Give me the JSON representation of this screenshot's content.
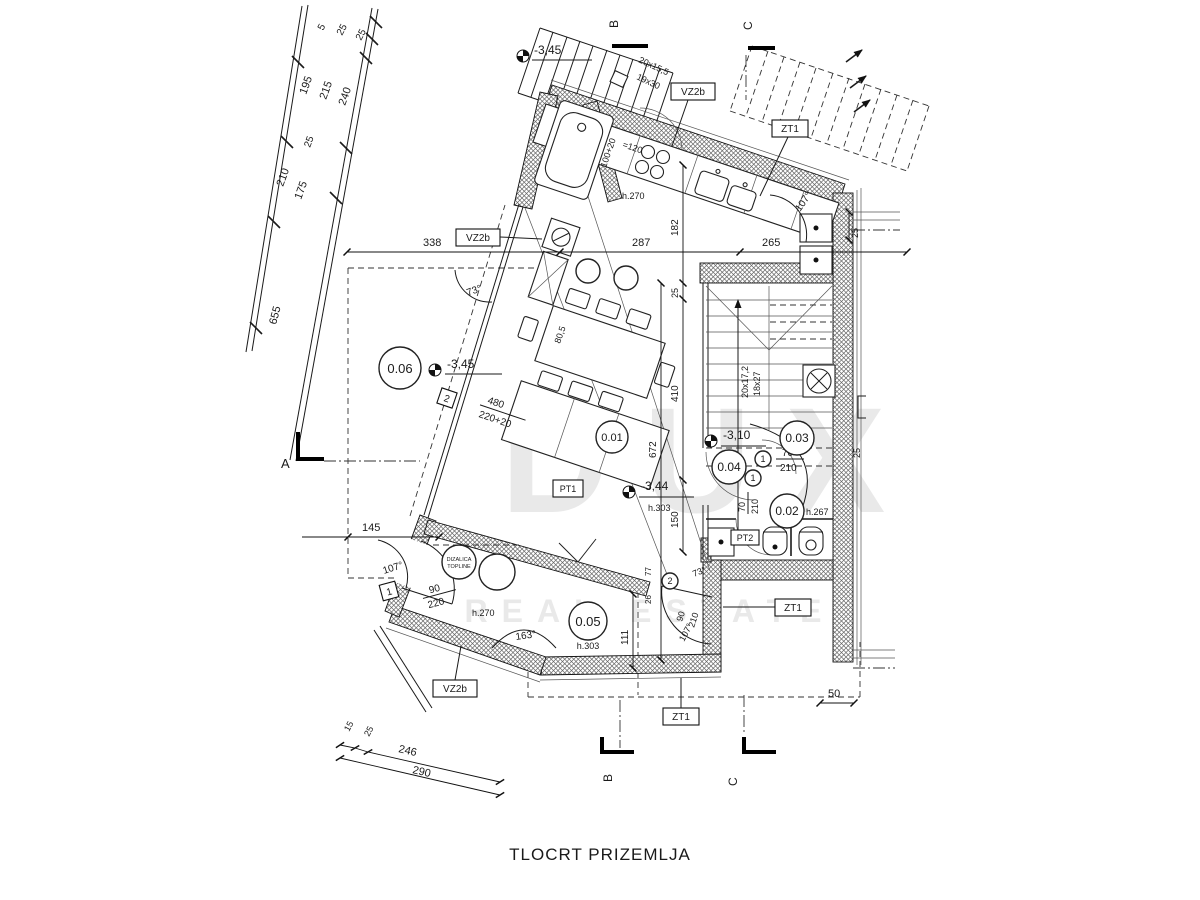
{
  "title": "TLOCRT PRIZEMLJA",
  "watermark": {
    "l1": "DUX",
    "l2": "REAL ESTATE"
  },
  "sections": {
    "a": "A",
    "b": "B",
    "c": "C"
  },
  "rooms": {
    "r1": "0.01",
    "r2": "0.02",
    "r2h": "h.267",
    "r3": "0.03",
    "r4": "0.04",
    "r5": "0.05",
    "r6": "0.06",
    "h303": "h.303",
    "h270": "h.270"
  },
  "levels": {
    "l345": "-3,45",
    "l344": "-3,44",
    "l310": "-3,10"
  },
  "tags": {
    "vz2b": "VZ2b",
    "zt1": "ZT1",
    "pt1": "PT1",
    "pt2": "PT2",
    "n1": "1",
    "n2": "2"
  },
  "stairs": {
    "ia": "20x17,2",
    "ib": "18x27",
    "ea": "20x15,5",
    "eb": "19x30"
  },
  "angles": {
    "a73": "73°",
    "a107": "107°",
    "a163": "163°"
  },
  "doors": {
    "w90": "90",
    "w220": "220",
    "w70": "70",
    "w210": "210"
  },
  "dims": {
    "top": [
      "338",
      "287",
      "265"
    ],
    "right": [
      "182",
      "25",
      "410",
      "150",
      "672",
      "111",
      "77",
      "26"
    ],
    "left": [
      "5",
      "25",
      "25",
      "195",
      "215",
      "240",
      "25",
      "210",
      "175",
      "655"
    ],
    "bottom": [
      "15",
      "25",
      "246",
      "290"
    ],
    "misc": {
      "d145": "145",
      "d50": "50",
      "d480": "480",
      "d480b": "220+20",
      "d120": "=120",
      "d100": "100+20",
      "d805": "80,5"
    }
  },
  "heatpump": {
    "l1": "DIZALICA",
    "l2": "TOPLINE"
  }
}
